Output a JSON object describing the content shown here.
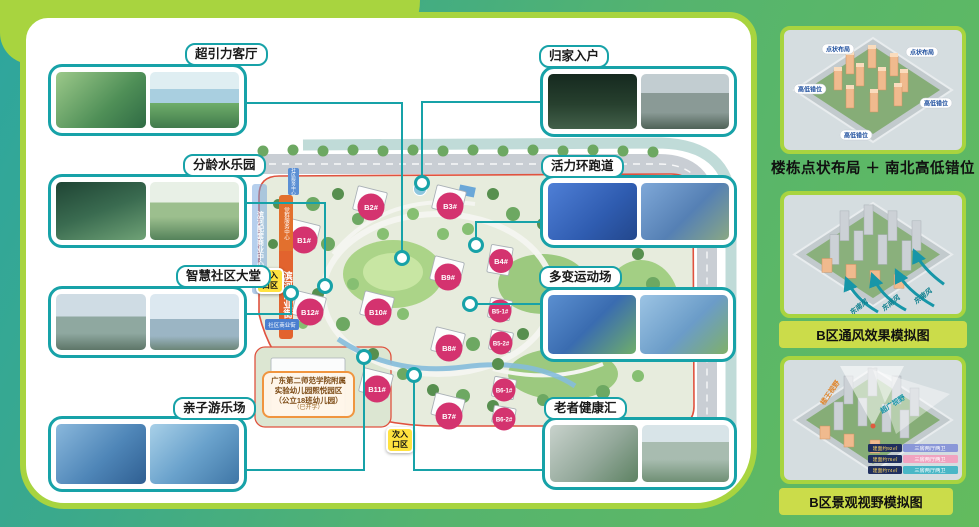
{
  "callouts": [
    {
      "label": "超引力客厅"
    },
    {
      "label": "分龄水乐园"
    },
    {
      "label": "智慧社区大堂"
    },
    {
      "label": "亲子游乐场"
    },
    {
      "label": "归家入户"
    },
    {
      "label": "活力环跑道"
    },
    {
      "label": "多变运动场"
    },
    {
      "label": "老者健康汇"
    }
  ],
  "site_plan": {
    "buildings": [
      "B1#",
      "B2#",
      "B3#",
      "B4#",
      "B9#",
      "B10#",
      "B12#",
      "B8#",
      "B11#",
      "B7#",
      "B5-1#",
      "B5-2#",
      "B6-1#",
      "B6-2#"
    ],
    "main_entrance": [
      "主入",
      "口区"
    ],
    "secondary_entrance": [
      "次入",
      "口区"
    ],
    "commercial_street": "滨河商业街",
    "party_service_center": "党群服务中心",
    "community_service_center": "社区服务中心",
    "community_shops": "社区商业街",
    "mixed_use_building": "滨河配套商业中心",
    "kindergarten": [
      "广东第二师范学院附属",
      "实验幼儿园熙悦园区",
      "（公立18班幼儿园）",
      "（已开学）"
    ]
  },
  "right_panel": {
    "section1": {
      "caption": "楼栋点状布局 ＋ 南北高低错位",
      "chips": [
        "点状布局",
        "点状布局",
        "高低错位",
        "高低错位",
        "高低错位"
      ]
    },
    "section2": {
      "caption": "B区通风效果模拟图",
      "wind_labels": [
        "东南风",
        "东南风",
        "东南风"
      ]
    },
    "section3": {
      "caption": "B区景观视野模拟图",
      "view_labels": [
        "楼王视野",
        "超广视野"
      ],
      "legend": [
        {
          "area": "建面约92㎡",
          "type": "三房两厅两卫",
          "color": "#8a97d8"
        },
        {
          "area": "建面约76㎡",
          "type": "三房两厅两卫",
          "color": "#f0a3c0"
        },
        {
          "area": "建面约74㎡",
          "type": "三房两厅两卫",
          "color": "#49b7c6"
        }
      ]
    }
  },
  "colors": {
    "accent_teal": "#17a2a8",
    "accent_lime": "#a8d43f",
    "building_label": "#d4336f",
    "entrance_badge": "#ffe23f",
    "commercial_banner": "#e2632e"
  }
}
